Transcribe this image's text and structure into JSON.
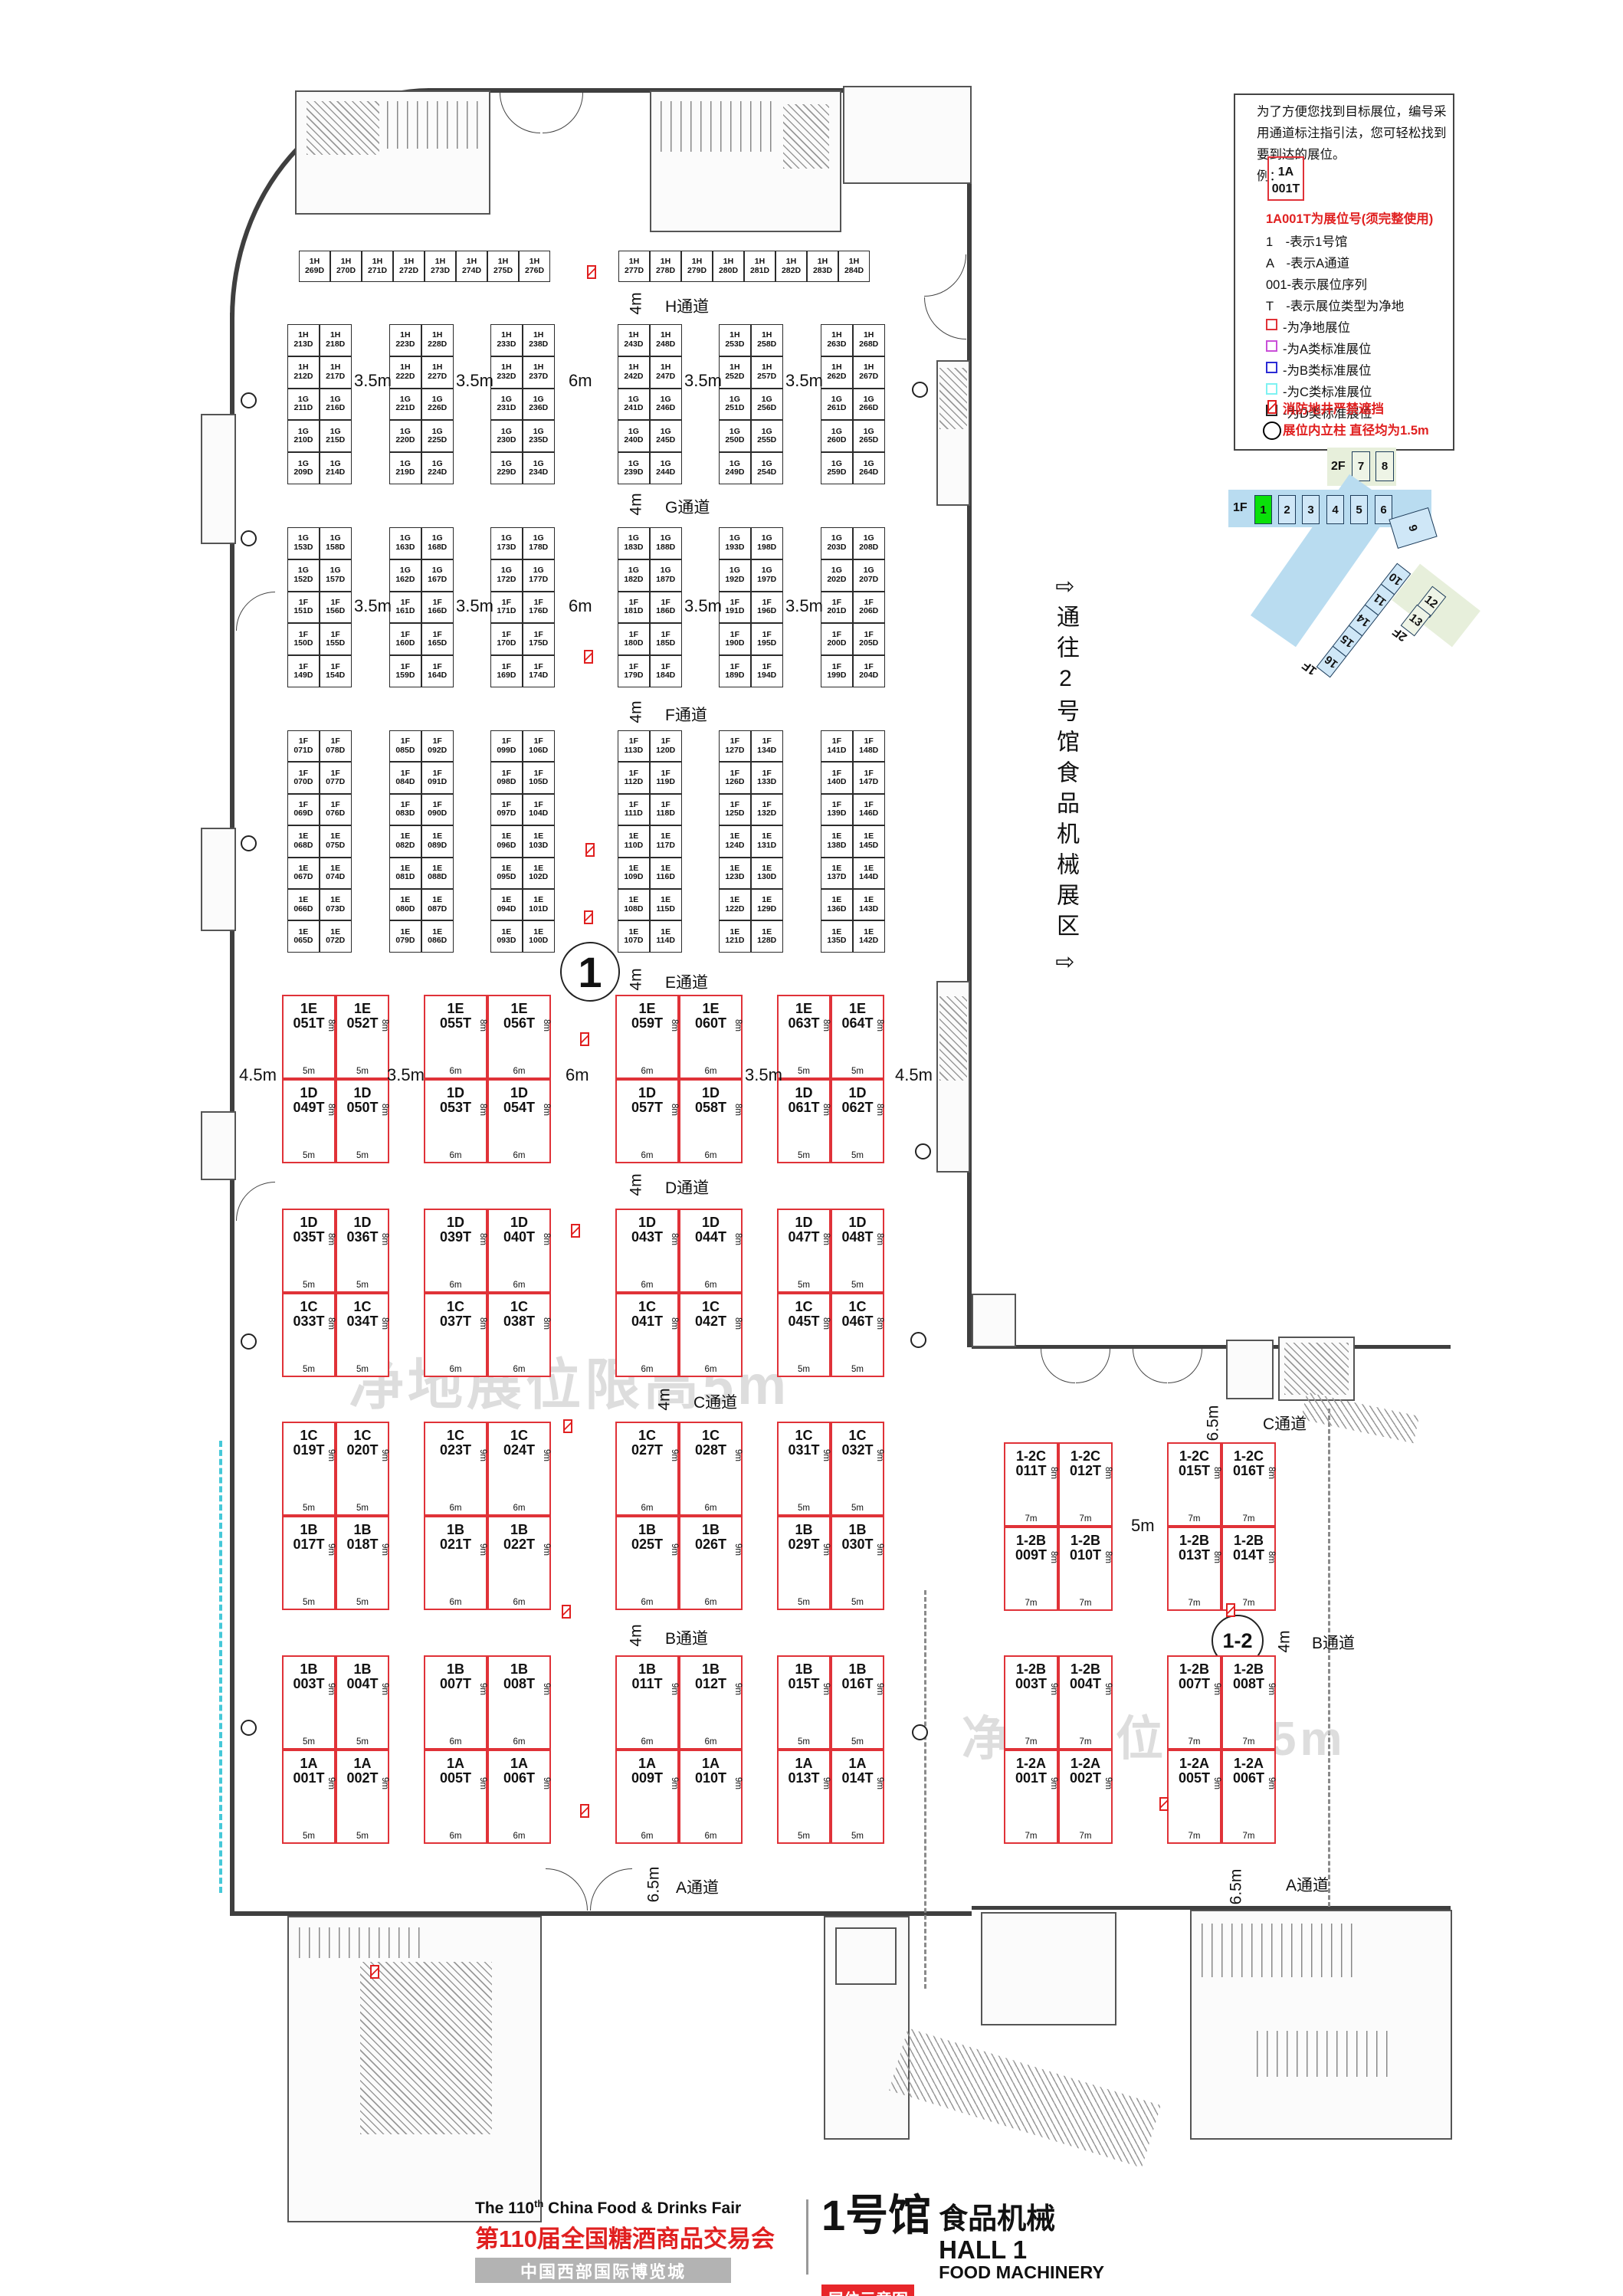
{
  "title": {
    "hall_cn": "1号馆",
    "hall_topic_cn": "食品机械",
    "hall_en": "HALL 1",
    "topic_en": "FOOD MACHINERY",
    "fair_en": "The 110",
    "fair_en_sup": "th",
    "fair_en_rest": " China Food & Drinks Fair",
    "fair_cn": "第110届全国糖酒商品交易会",
    "venue": "中国西部国际博览城",
    "map_tag": "展位示意图"
  },
  "watermark": "净地展位限高5m",
  "corridor_note": {
    "arrow": "⇨",
    "text": "通往2号馆食品机械展区"
  },
  "hall_circle": "1",
  "annex_circle": "1-2",
  "legend": {
    "intro": [
      "为了方便您找到目标展位，编号采",
      "用通道标注指引法，您可轻松找到",
      "要到达的展位。",
      "例："
    ],
    "example": {
      "line1": "1A",
      "line2": "001T"
    },
    "booth_no_note": "1A001T为展位号(须完整使用)",
    "keys": [
      "1　-表示1号馆",
      "A　-表示A通道",
      "001-表示展位序列",
      "T　-表示展位类型为净地"
    ],
    "types": [
      {
        "color": "#e03238",
        "label": "-为净地展位"
      },
      {
        "color": "#c94fd8",
        "label": "-为A类标准展位"
      },
      {
        "color": "#2b2bd5",
        "label": "-为B类标准展位"
      },
      {
        "color": "#7ef2f2",
        "label": "-为C类标准展位"
      },
      {
        "color": "#222222",
        "label": "-为D类标准展位"
      }
    ],
    "fire_note": "消防地井严禁遮挡",
    "column_note": "展位内立柱 直径均为1.5m"
  },
  "minimap": {
    "f2_label": "2F",
    "f1_label": "1F",
    "f2_halls": [
      "7",
      "8"
    ],
    "f1_halls": [
      "1",
      "2",
      "3",
      "4",
      "5",
      "6"
    ],
    "hall9": "9",
    "arm_halls": [
      "10",
      "11",
      "14",
      "15",
      "16"
    ],
    "arm_label": "1F",
    "green_arm_halls": [
      "12",
      "13"
    ],
    "green_arm_label": "2F",
    "active_color": "#0ae00a",
    "band_color": "#b9dcf0",
    "box_color": "#cfe7f7",
    "green_bg": "#e7efdb"
  },
  "aisles_left": [
    {
      "name": "H通道",
      "dim": "4m"
    },
    {
      "name": "G通道",
      "dim": "4m"
    },
    {
      "name": "F通道",
      "dim": "4m"
    },
    {
      "name": "E通道",
      "dim": "4m"
    },
    {
      "name": "D通道",
      "dim": "4m"
    },
    {
      "name": "C通道",
      "dim": "4m"
    },
    {
      "name": "B通道",
      "dim": "4m"
    },
    {
      "name": "A通道",
      "dim": "6.5m"
    }
  ],
  "aisles_annex": {
    "c": "C通道",
    "c_dim": "6.5m",
    "mid_dim": "5m",
    "b": "B通道",
    "b_dim": "4m",
    "a": "A通道",
    "a_dim": "6.5m"
  },
  "gap_dims_band2": [
    "3.5m",
    "3.5m",
    "6m",
    "3.5m",
    "3.5m"
  ],
  "gap_dims_band3": [
    "3.5m",
    "3.5m",
    "6m",
    "3.5m",
    "3.5m"
  ],
  "gap_dims_tband": [
    "4.5m",
    "3.5m",
    "6m",
    "3.5m",
    "4.5m"
  ],
  "band_h_row_a": [
    "1H 269D",
    "1H 270D",
    "1H 271D",
    "1H 272D",
    "1H 273D",
    "1H 274D",
    "1H 275D",
    "1H 276D"
  ],
  "band_h_row_b": [
    "1H 277D",
    "1H 278D",
    "1H 279D",
    "1H 280D",
    "1H 281D",
    "1H 282D",
    "1H 283D",
    "1H 284D"
  ],
  "band2_blocks": [
    [
      [
        "1H 213D",
        "1H 218D"
      ],
      [
        "1H 212D",
        "1H 217D"
      ],
      [
        "1G 211D",
        "1G 216D"
      ],
      [
        "1G 210D",
        "1G 215D"
      ],
      [
        "1G 209D",
        "1G 214D"
      ]
    ],
    [
      [
        "1H 223D",
        "1H 228D"
      ],
      [
        "1H 222D",
        "1H 227D"
      ],
      [
        "1G 221D",
        "1G 226D"
      ],
      [
        "1G 220D",
        "1G 225D"
      ],
      [
        "1G 219D",
        "1G 224D"
      ]
    ],
    [
      [
        "1H 233D",
        "1H 238D"
      ],
      [
        "1H 232D",
        "1H 237D"
      ],
      [
        "1G 231D",
        "1G 236D"
      ],
      [
        "1G 230D",
        "1G 235D"
      ],
      [
        "1G 229D",
        "1G 234D"
      ]
    ],
    [
      [
        "1H 243D",
        "1H 248D"
      ],
      [
        "1H 242D",
        "1H 247D"
      ],
      [
        "1G 241D",
        "1G 246D"
      ],
      [
        "1G 240D",
        "1G 245D"
      ],
      [
        "1G 239D",
        "1G 244D"
      ]
    ],
    [
      [
        "1H 253D",
        "1H 258D"
      ],
      [
        "1H 252D",
        "1H 257D"
      ],
      [
        "1G 251D",
        "1G 256D"
      ],
      [
        "1G 250D",
        "1G 255D"
      ],
      [
        "1G 249D",
        "1G 254D"
      ]
    ],
    [
      [
        "1H 263D",
        "1H 268D"
      ],
      [
        "1H 262D",
        "1H 267D"
      ],
      [
        "1G 261D",
        "1G 266D"
      ],
      [
        "1G 260D",
        "1G 265D"
      ],
      [
        "1G 259D",
        "1G 264D"
      ]
    ]
  ],
  "band3_blocks": [
    [
      [
        "1G 153D",
        "1G 158D"
      ],
      [
        "1G 152D",
        "1G 157D"
      ],
      [
        "1F 151D",
        "1F 156D"
      ],
      [
        "1F 150D",
        "1F 155D"
      ],
      [
        "1F 149D",
        "1F 154D"
      ]
    ],
    [
      [
        "1G 163D",
        "1G 168D"
      ],
      [
        "1G 162D",
        "1G 167D"
      ],
      [
        "1F 161D",
        "1F 166D"
      ],
      [
        "1F 160D",
        "1F 165D"
      ],
      [
        "1F 159D",
        "1F 164D"
      ]
    ],
    [
      [
        "1G 173D",
        "1G 178D"
      ],
      [
        "1G 172D",
        "1G 177D"
      ],
      [
        "1F 171D",
        "1F 176D"
      ],
      [
        "1F 170D",
        "1F 175D"
      ],
      [
        "1F 169D",
        "1F 174D"
      ]
    ],
    [
      [
        "1G 183D",
        "1G 188D"
      ],
      [
        "1G 182D",
        "1G 187D"
      ],
      [
        "1F 181D",
        "1F 186D"
      ],
      [
        "1F 180D",
        "1F 185D"
      ],
      [
        "1F 179D",
        "1F 184D"
      ]
    ],
    [
      [
        "1G 193D",
        "1G 198D"
      ],
      [
        "1G 192D",
        "1G 197D"
      ],
      [
        "1F 191D",
        "1F 196D"
      ],
      [
        "1F 190D",
        "1F 195D"
      ],
      [
        "1F 189D",
        "1F 194D"
      ]
    ],
    [
      [
        "1G 203D",
        "1G 208D"
      ],
      [
        "1G 202D",
        "1G 207D"
      ],
      [
        "1F 201D",
        "1F 206D"
      ],
      [
        "1F 200D",
        "1F 205D"
      ],
      [
        "1F 199D",
        "1F 204D"
      ]
    ]
  ],
  "band4_blocks": [
    [
      [
        "1F 071D",
        "1F 078D"
      ],
      [
        "1F 070D",
        "1F 077D"
      ],
      [
        "1F 069D",
        "1F 076D"
      ],
      [
        "1E 068D",
        "1E 075D"
      ],
      [
        "1E 067D",
        "1E 074D"
      ],
      [
        "1E 066D",
        "1E 073D"
      ],
      [
        "1E 065D",
        "1E 072D"
      ]
    ],
    [
      [
        "1F 085D",
        "1F 092D"
      ],
      [
        "1F 084D",
        "1F 091D"
      ],
      [
        "1F 083D",
        "1F 090D"
      ],
      [
        "1E 082D",
        "1E 089D"
      ],
      [
        "1E 081D",
        "1E 088D"
      ],
      [
        "1E 080D",
        "1E 087D"
      ],
      [
        "1E 079D",
        "1E 086D"
      ]
    ],
    [
      [
        "1F 099D",
        "1F 106D"
      ],
      [
        "1F 098D",
        "1F 105D"
      ],
      [
        "1F 097D",
        "1F 104D"
      ],
      [
        "1E 096D",
        "1E 103D"
      ],
      [
        "1E 095D",
        "1E 102D"
      ],
      [
        "1E 094D",
        "1E 101D"
      ],
      [
        "1E 093D",
        "1E 100D"
      ]
    ],
    [
      [
        "1F 113D",
        "1F 120D"
      ],
      [
        "1F 112D",
        "1F 119D"
      ],
      [
        "1F 111D",
        "1F 118D"
      ],
      [
        "1E 110D",
        "1E 117D"
      ],
      [
        "1E 109D",
        "1E 116D"
      ],
      [
        "1E 108D",
        "1E 115D"
      ],
      [
        "1E 107D",
        "1E 114D"
      ]
    ],
    [
      [
        "1F 127D",
        "1F 134D"
      ],
      [
        "1F 126D",
        "1F 133D"
      ],
      [
        "1F 125D",
        "1F 132D"
      ],
      [
        "1E 124D",
        "1E 131D"
      ],
      [
        "1E 123D",
        "1E 130D"
      ],
      [
        "1E 122D",
        "1E 129D"
      ],
      [
        "1E 121D",
        "1E 128D"
      ]
    ],
    [
      [
        "1F 141D",
        "1F 148D"
      ],
      [
        "1F 140D",
        "1F 147D"
      ],
      [
        "1F 139D",
        "1F 146D"
      ],
      [
        "1E 138D",
        "1E 145D"
      ],
      [
        "1E 137D",
        "1E 144D"
      ],
      [
        "1E 136D",
        "1E 143D"
      ],
      [
        "1E 135D",
        "1E 142D"
      ]
    ]
  ],
  "t_bands_left": [
    {
      "h": "8m",
      "groups": [
        {
          "w": "5m",
          "top": [
            "1E 051T",
            "1E 052T"
          ],
          "bot": [
            "1D 049T",
            "1D 050T"
          ]
        },
        {
          "w": "6m",
          "top": [
            "1E 055T",
            "1E 056T"
          ],
          "bot": [
            "1D 053T",
            "1D 054T"
          ]
        },
        {
          "w": "6m",
          "top": [
            "1E 059T",
            "1E 060T"
          ],
          "bot": [
            "1D 057T",
            "1D 058T"
          ]
        },
        {
          "w": "5m",
          "top": [
            "1E 063T",
            "1E 064T"
          ],
          "bot": [
            "1D 061T",
            "1D 062T"
          ]
        }
      ]
    },
    {
      "h": "8m",
      "groups": [
        {
          "w": "5m",
          "top": [
            "1D 035T",
            "1D 036T"
          ],
          "bot": [
            "1C 033T",
            "1C 034T"
          ]
        },
        {
          "w": "6m",
          "top": [
            "1D 039T",
            "1D 040T"
          ],
          "bot": [
            "1C 037T",
            "1C 038T"
          ]
        },
        {
          "w": "6m",
          "top": [
            "1D 043T",
            "1D 044T"
          ],
          "bot": [
            "1C 041T",
            "1C 042T"
          ]
        },
        {
          "w": "5m",
          "top": [
            "1D 047T",
            "1D 048T"
          ],
          "bot": [
            "1C 045T",
            "1C 046T"
          ]
        }
      ]
    },
    {
      "h": "9m",
      "groups": [
        {
          "w": "5m",
          "top": [
            "1C 019T",
            "1C 020T"
          ],
          "bot": [
            "1B 017T",
            "1B 018T"
          ]
        },
        {
          "w": "6m",
          "top": [
            "1C 023T",
            "1C 024T"
          ],
          "bot": [
            "1B 021T",
            "1B 022T"
          ]
        },
        {
          "w": "6m",
          "top": [
            "1C 027T",
            "1C 028T"
          ],
          "bot": [
            "1B 025T",
            "1B 026T"
          ]
        },
        {
          "w": "5m",
          "top": [
            "1C 031T",
            "1C 032T"
          ],
          "bot": [
            "1B 029T",
            "1B 030T"
          ]
        }
      ]
    },
    {
      "h": "9m",
      "groups": [
        {
          "w": "5m",
          "top": [
            "1B 003T",
            "1B 004T"
          ],
          "bot": [
            "1A 001T",
            "1A 002T"
          ]
        },
        {
          "w": "6m",
          "top": [
            "1B 007T",
            "1B 008T"
          ],
          "bot": [
            "1A 005T",
            "1A 006T"
          ]
        },
        {
          "w": "6m",
          "top": [
            "1B 011T",
            "1B 012T"
          ],
          "bot": [
            "1A 009T",
            "1A 010T"
          ]
        },
        {
          "w": "5m",
          "top": [
            "1B 015T",
            "1B 016T"
          ],
          "bot": [
            "1A 013T",
            "1A 014T"
          ]
        }
      ]
    }
  ],
  "t_bands_annex": [
    {
      "h": "8m",
      "groups": [
        {
          "w": "7m",
          "top": [
            "1-2C 011T",
            "1-2C 012T"
          ],
          "bot": [
            "1-2B 009T",
            "1-2B 010T"
          ]
        },
        {
          "w": "7m",
          "top": [
            "1-2C 015T",
            "1-2C 016T"
          ],
          "bot": [
            "1-2B 013T",
            "1-2B 014T"
          ]
        }
      ]
    },
    {
      "h": "9m",
      "groups": [
        {
          "w": "7m",
          "top": [
            "1-2B 003T",
            "1-2B 004T"
          ],
          "bot": [
            "1-2A 001T",
            "1-2A 002T"
          ]
        },
        {
          "w": "7m",
          "top": [
            "1-2B 007T",
            "1-2B 008T"
          ],
          "bot": [
            "1-2A 005T",
            "1-2A 006T"
          ]
        }
      ]
    }
  ]
}
